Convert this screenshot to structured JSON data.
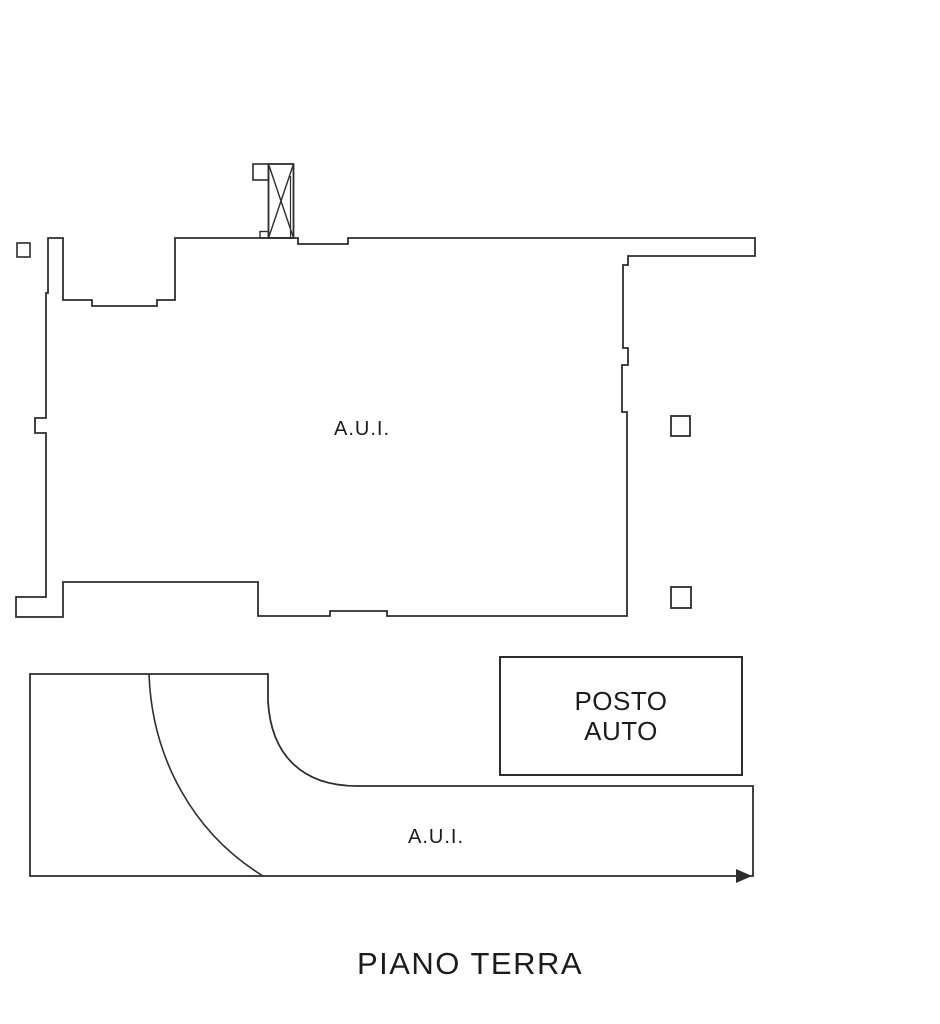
{
  "title": "PIANO TERRA",
  "plan": {
    "upper_unit": {
      "label": "A.U.I."
    },
    "lower_unit": {
      "label": "A.U.I."
    },
    "parking": {
      "line1": "POSTO",
      "line2": "AUTO"
    }
  },
  "colors": {
    "line": "#2d2d2d",
    "background": "#ffffff",
    "text": "#1c1c1c"
  }
}
